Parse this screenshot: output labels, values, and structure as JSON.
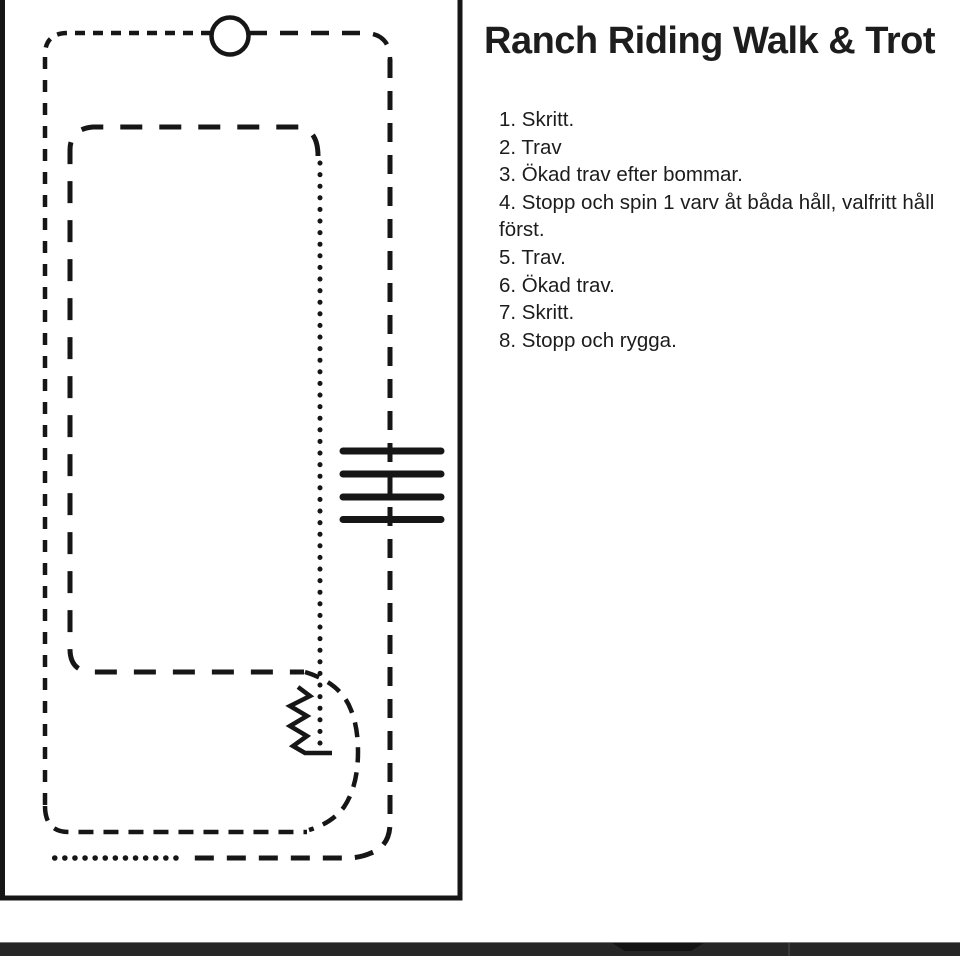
{
  "page": {
    "title": "Ranch Riding Walk & Trot",
    "instructions": [
      "1. Skritt.",
      "2. Trav",
      "3. Ökad trav efter bommar.",
      "4. Stopp och spin 1 varv åt båda håll, valfritt håll\nförst.",
      "5. Trav.",
      "6. Ökad trav.",
      "7. Skritt.",
      "8. Stopp och rygga."
    ]
  },
  "diagram": {
    "kind": "ranch-riding-pattern",
    "markers": [
      "arena-border",
      "start-marker-circle",
      "walk-dash-path",
      "trot-dash-paths",
      "walk-dot-paths",
      "trot-poles-x4",
      "backup-zigzag"
    ],
    "poles_count": 4
  },
  "colors": {
    "ink": "#161616",
    "paper": "#ffffff",
    "bottom_bar": "#262626"
  }
}
